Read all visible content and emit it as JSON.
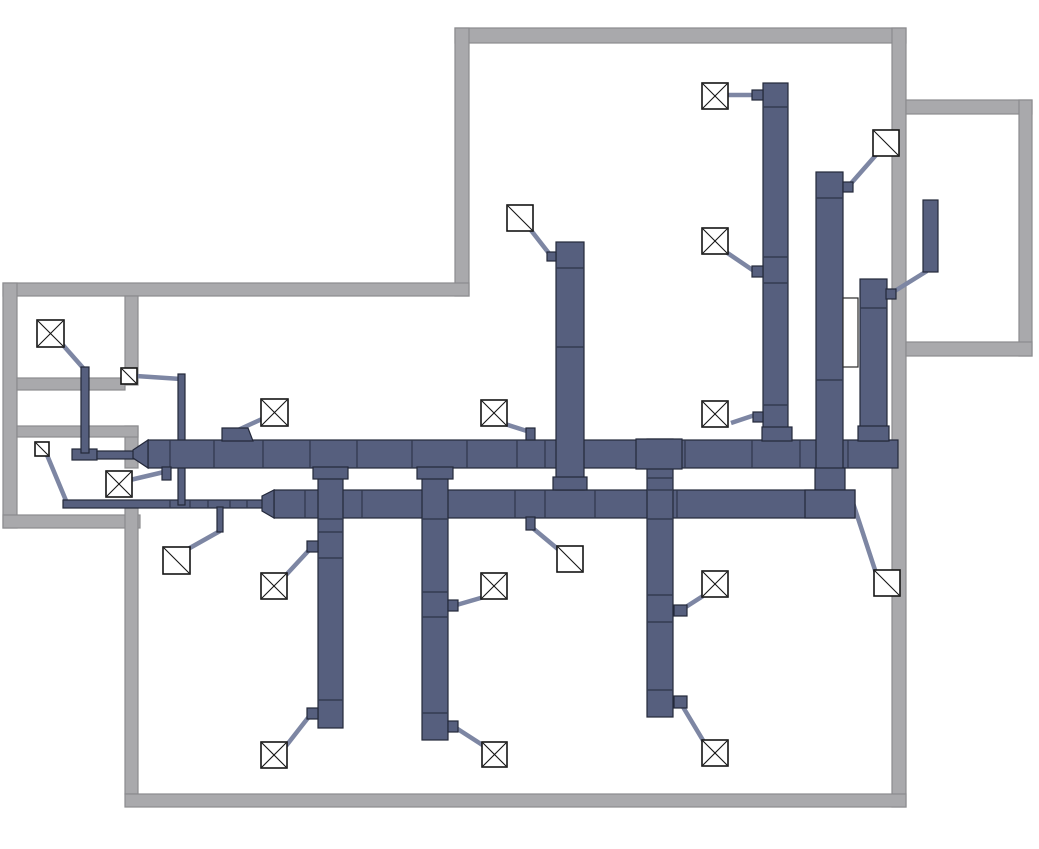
{
  "meta": {
    "description": "HVAC supply ductwork floor plan drawing with wall outlines, trunk ducts, branch risers, flexible connectors and ceiling diffusers",
    "canvas_width": 1039,
    "canvas_height": 849
  },
  "palette": {
    "background": "#ffffff",
    "wall_fill": "#a9a9ac",
    "wall_stroke": "#8b8b8e",
    "duct_fill": "#565f7e",
    "duct_stroke": "#23283a",
    "connector_stroke": "#7d86a3",
    "diffuser_fill": "#ffffff",
    "diffuser_stroke": "#141414",
    "equipment_white_fill": "#ffffff",
    "equipment_white_stroke": "#2a2a2a"
  },
  "walls": [
    {
      "id": "wall-top",
      "x": 455,
      "y": 28,
      "w": 451,
      "h": 15
    },
    {
      "id": "wall-right",
      "x": 892,
      "y": 28,
      "w": 14,
      "h": 779
    },
    {
      "id": "wall-upper-left-vertical",
      "x": 455,
      "y": 28,
      "w": 14,
      "h": 268
    },
    {
      "id": "wall-mid-horizontal",
      "x": 3,
      "y": 283,
      "w": 466,
      "h": 13
    },
    {
      "id": "wall-left-outer",
      "x": 3,
      "y": 283,
      "w": 14,
      "h": 245
    },
    {
      "id": "wall-left-room-bottom",
      "x": 3,
      "y": 515,
      "w": 137,
      "h": 13
    },
    {
      "id": "wall-inner-vertical-a",
      "x": 125,
      "y": 296,
      "w": 13,
      "h": 89
    },
    {
      "id": "wall-inner-vertical-b",
      "x": 125,
      "y": 426,
      "w": 13,
      "h": 42
    },
    {
      "id": "wall-inner-vertical-c",
      "x": 125,
      "y": 508,
      "w": 13,
      "h": 286
    },
    {
      "id": "wall-left-partition-1",
      "x": 17,
      "y": 378,
      "w": 108,
      "h": 12
    },
    {
      "id": "wall-left-partition-2",
      "x": 17,
      "y": 426,
      "w": 121,
      "h": 11
    },
    {
      "id": "wall-bottom",
      "x": 125,
      "y": 794,
      "w": 781,
      "h": 13
    },
    {
      "id": "wall-right-room-top",
      "x": 906,
      "y": 100,
      "w": 126,
      "h": 14
    },
    {
      "id": "wall-right-room-right",
      "x": 1019,
      "y": 100,
      "w": 13,
      "h": 256
    },
    {
      "id": "wall-right-room-bottom",
      "x": 906,
      "y": 342,
      "w": 126,
      "h": 14
    }
  ],
  "connectors": [
    {
      "x1": 62,
      "y1": 344,
      "x2": 84,
      "y2": 369
    },
    {
      "x1": 130,
      "y1": 480,
      "x2": 164,
      "y2": 472
    },
    {
      "x1": 47,
      "y1": 455,
      "x2": 67,
      "y2": 503
    },
    {
      "x1": 188,
      "y1": 549,
      "x2": 220,
      "y2": 531
    },
    {
      "x1": 136,
      "y1": 376,
      "x2": 181,
      "y2": 379
    },
    {
      "x1": 238,
      "y1": 430,
      "x2": 262,
      "y2": 419
    },
    {
      "x1": 505,
      "y1": 424,
      "x2": 530,
      "y2": 432
    },
    {
      "x1": 731,
      "y1": 423,
      "x2": 755,
      "y2": 415
    },
    {
      "x1": 286,
      "y1": 575,
      "x2": 311,
      "y2": 548
    },
    {
      "x1": 286,
      "y1": 746,
      "x2": 311,
      "y2": 714
    },
    {
      "x1": 484,
      "y1": 597,
      "x2": 453,
      "y2": 606
    },
    {
      "x1": 484,
      "y1": 746,
      "x2": 453,
      "y2": 726
    },
    {
      "x1": 728,
      "y1": 95,
      "x2": 753,
      "y2": 95
    },
    {
      "x1": 726,
      "y1": 252,
      "x2": 754,
      "y2": 271
    },
    {
      "x1": 678,
      "y1": 612,
      "x2": 703,
      "y2": 596
    },
    {
      "x1": 680,
      "y1": 702,
      "x2": 704,
      "y2": 742
    },
    {
      "x1": 530,
      "y1": 229,
      "x2": 551,
      "y2": 256
    },
    {
      "x1": 876,
      "y1": 155,
      "x2": 847,
      "y2": 188
    },
    {
      "x1": 876,
      "y1": 573,
      "x2": 853,
      "y2": 503
    },
    {
      "x1": 559,
      "y1": 550,
      "x2": 529,
      "y2": 525
    },
    {
      "x1": 927,
      "y1": 271,
      "x2": 890,
      "y2": 294
    }
  ],
  "thin_ducts": [
    {
      "id": "duct-foot-left",
      "x": 72,
      "y": 449,
      "w": 25,
      "h": 11,
      "joints_x": []
    },
    {
      "id": "duct-run-left-upper",
      "x": 97,
      "y": 451,
      "w": 37,
      "h": 8,
      "joints_x": []
    },
    {
      "id": "duct-run-left-lower",
      "x": 63,
      "y": 500,
      "w": 200,
      "h": 8,
      "joints_x": [
        170,
        190,
        208,
        230,
        247
      ]
    },
    {
      "id": "duct-riser-left-room",
      "x": 81,
      "y": 367,
      "w": 8,
      "h": 86,
      "joints_x": []
    },
    {
      "id": "duct-riser-crossing",
      "x": 178,
      "y": 374,
      "w": 7,
      "h": 131,
      "joints_x": []
    }
  ],
  "main_ducts": [
    {
      "id": "duct-main-upper",
      "x": 148,
      "y": 440,
      "w": 750,
      "h": 28,
      "joints_x": [
        170,
        214,
        263,
        310,
        357,
        412,
        467,
        517,
        545,
        637,
        685,
        752,
        800,
        848
      ],
      "taper": [
        [
          133,
          450
        ],
        [
          148,
          440
        ],
        [
          148,
          468
        ],
        [
          133,
          458
        ]
      ]
    },
    {
      "id": "duct-main-lower",
      "x": 274,
      "y": 490,
      "w": 581,
      "h": 28,
      "joints_x": [
        305,
        362,
        515,
        545,
        595,
        677,
        805
      ],
      "taper": [
        [
          262,
          496
        ],
        [
          274,
          490
        ],
        [
          274,
          518
        ],
        [
          262,
          511
        ]
      ]
    }
  ],
  "vertical_ducts": [
    {
      "id": "duct-riser-ne-1",
      "x": 763,
      "y": 83,
      "w": 25,
      "h": 357,
      "joints_y": [
        107,
        257,
        283,
        405
      ]
    },
    {
      "id": "duct-riser-ne-2",
      "x": 816,
      "y": 172,
      "w": 27,
      "h": 318,
      "joints_y": [
        198,
        380
      ]
    },
    {
      "id": "duct-riser-ne-3",
      "x": 860,
      "y": 279,
      "w": 27,
      "h": 162,
      "joints_y": [
        308
      ]
    },
    {
      "id": "duct-riser-center",
      "x": 556,
      "y": 242,
      "w": 28,
      "h": 248,
      "joints_y": [
        268,
        347
      ]
    },
    {
      "id": "duct-branch-south-1",
      "x": 318,
      "y": 468,
      "w": 25,
      "h": 260,
      "joints_y": [
        519,
        532,
        558,
        700
      ]
    },
    {
      "id": "duct-branch-south-2",
      "x": 422,
      "y": 468,
      "w": 26,
      "h": 272,
      "joints_y": [
        519,
        592,
        617,
        713
      ]
    },
    {
      "id": "duct-branch-south-3",
      "x": 647,
      "y": 439,
      "w": 26,
      "h": 278,
      "joints_y": [
        478,
        490,
        519,
        595,
        622,
        690
      ]
    }
  ],
  "fittings": [
    {
      "id": "fitting-collar-branch-1",
      "type": "rect",
      "x": 313,
      "y": 467,
      "w": 35,
      "h": 12
    },
    {
      "id": "fitting-collar-branch-2",
      "type": "rect",
      "x": 417,
      "y": 467,
      "w": 36,
      "h": 12
    },
    {
      "id": "fitting-collar-riser-center",
      "type": "rect",
      "x": 553,
      "y": 477,
      "w": 34,
      "h": 13
    },
    {
      "id": "fitting-collar-riser-ne-1",
      "type": "rect",
      "x": 762,
      "y": 427,
      "w": 30,
      "h": 14
    },
    {
      "id": "fitting-collar-riser-ne-3",
      "type": "rect",
      "x": 858,
      "y": 426,
      "w": 31,
      "h": 15
    },
    {
      "id": "fitting-tee-branch-3",
      "type": "rect",
      "x": 636,
      "y": 439,
      "w": 46,
      "h": 30
    },
    {
      "id": "fitting-elbow-riser",
      "type": "rect",
      "x": 815,
      "y": 468,
      "w": 30,
      "h": 22
    },
    {
      "id": "fitting-elbow-lower-end",
      "type": "rect",
      "x": 805,
      "y": 490,
      "w": 50,
      "h": 28
    },
    {
      "id": "fitting-transition-top",
      "type": "polygon",
      "points": [
        [
          222,
          441
        ],
        [
          222,
          428
        ],
        [
          248,
          428
        ],
        [
          253,
          441
        ]
      ]
    }
  ],
  "stubs": [
    {
      "id": "stub-1",
      "x": 162,
      "y": 467,
      "w": 9,
      "h": 13
    },
    {
      "id": "stub-2",
      "x": 217,
      "y": 507,
      "w": 6,
      "h": 25
    },
    {
      "id": "stub-3",
      "x": 526,
      "y": 428,
      "w": 9,
      "h": 12
    },
    {
      "id": "stub-4",
      "x": 752,
      "y": 90,
      "w": 11,
      "h": 10
    },
    {
      "id": "stub-5",
      "x": 752,
      "y": 266,
      "w": 11,
      "h": 11
    },
    {
      "id": "stub-6",
      "x": 753,
      "y": 412,
      "w": 10,
      "h": 10
    },
    {
      "id": "stub-7",
      "x": 843,
      "y": 182,
      "w": 10,
      "h": 10
    },
    {
      "id": "stub-8",
      "x": 886,
      "y": 289,
      "w": 10,
      "h": 10
    },
    {
      "id": "stub-9",
      "x": 307,
      "y": 541,
      "w": 11,
      "h": 11
    },
    {
      "id": "stub-10",
      "x": 307,
      "y": 708,
      "w": 11,
      "h": 11
    },
    {
      "id": "stub-11",
      "x": 448,
      "y": 600,
      "w": 10,
      "h": 11
    },
    {
      "id": "stub-12",
      "x": 448,
      "y": 721,
      "w": 10,
      "h": 11
    },
    {
      "id": "stub-13",
      "x": 674,
      "y": 605,
      "w": 13,
      "h": 11
    },
    {
      "id": "stub-14",
      "x": 674,
      "y": 696,
      "w": 13,
      "h": 12
    },
    {
      "id": "stub-15",
      "x": 526,
      "y": 517,
      "w": 9,
      "h": 13
    },
    {
      "id": "stub-16",
      "x": 547,
      "y": 252,
      "w": 9,
      "h": 9
    }
  ],
  "equipment": [
    {
      "id": "equipment-white-panel",
      "x": 843,
      "y": 298,
      "w": 15,
      "h": 69,
      "style": "white"
    },
    {
      "id": "equipment-dark-panel",
      "x": 923,
      "y": 200,
      "w": 15,
      "h": 72,
      "style": "dark"
    }
  ],
  "diffusers": [
    {
      "id": "diffuser-nw-room",
      "x": 37,
      "y": 320,
      "size": 27,
      "style": "cross"
    },
    {
      "id": "diffuser-left-mid",
      "x": 106,
      "y": 471,
      "size": 26,
      "style": "cross"
    },
    {
      "id": "diffuser-row1-a",
      "x": 261,
      "y": 399,
      "size": 27,
      "style": "cross"
    },
    {
      "id": "diffuser-row1-b",
      "x": 481,
      "y": 400,
      "size": 26,
      "style": "cross"
    },
    {
      "id": "diffuser-row1-c",
      "x": 702,
      "y": 401,
      "size": 26,
      "style": "cross"
    },
    {
      "id": "diffuser-ne-top",
      "x": 702,
      "y": 83,
      "size": 26,
      "style": "cross"
    },
    {
      "id": "diffuser-ne-mid",
      "x": 702,
      "y": 228,
      "size": 26,
      "style": "cross"
    },
    {
      "id": "diffuser-row2-a",
      "x": 261,
      "y": 573,
      "size": 26,
      "style": "cross"
    },
    {
      "id": "diffuser-row2-b",
      "x": 481,
      "y": 573,
      "size": 26,
      "style": "cross"
    },
    {
      "id": "diffuser-row2-c",
      "x": 702,
      "y": 571,
      "size": 26,
      "style": "cross"
    },
    {
      "id": "diffuser-row3-a",
      "x": 261,
      "y": 742,
      "size": 26,
      "style": "cross"
    },
    {
      "id": "diffuser-row3-b",
      "x": 482,
      "y": 742,
      "size": 25,
      "style": "cross"
    },
    {
      "id": "diffuser-row3-c",
      "x": 702,
      "y": 740,
      "size": 26,
      "style": "cross"
    },
    {
      "id": "grille-wall-small",
      "x": 121,
      "y": 368,
      "size": 16,
      "style": "slash"
    },
    {
      "id": "grille-left-small",
      "x": 35,
      "y": 442,
      "size": 14,
      "style": "slash"
    },
    {
      "id": "grille-left-low",
      "x": 163,
      "y": 547,
      "size": 27,
      "style": "slash"
    },
    {
      "id": "grille-center-top",
      "x": 507,
      "y": 205,
      "size": 26,
      "style": "slash"
    },
    {
      "id": "grille-ne-corner",
      "x": 873,
      "y": 130,
      "size": 26,
      "style": "slash"
    },
    {
      "id": "grille-se",
      "x": 874,
      "y": 570,
      "size": 26,
      "style": "slash"
    },
    {
      "id": "grille-center-low",
      "x": 557,
      "y": 546,
      "size": 26,
      "style": "slash"
    }
  ]
}
